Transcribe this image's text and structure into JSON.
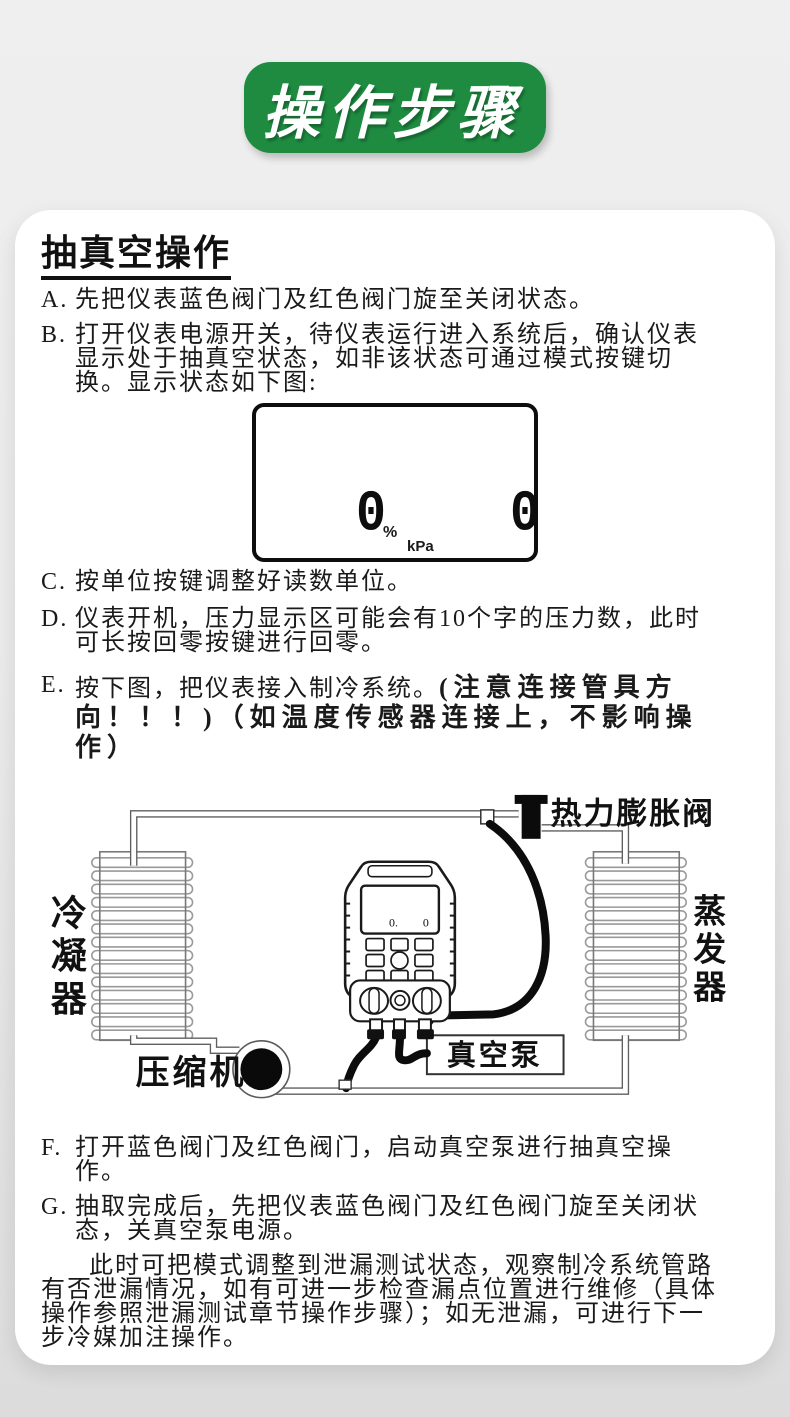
{
  "badge": {
    "title": "操作步骤",
    "color": "#1e8b41"
  },
  "section": {
    "heading": "抽真空操作"
  },
  "steps": [
    {
      "label": "A.",
      "text": "先把仪表蓝色阀门及红色阀门旋至关闭状态。"
    },
    {
      "label": "B.",
      "text": "打开仪表电源开关，待仪表运行进入系统后，确认仪表显示处于抽真空状态，如非该状态可通过模式按键切换。显示状态如下图:"
    },
    {
      "label": "C.",
      "text": "按单位按键调整好读数单位。"
    },
    {
      "label": "D.",
      "text": "仪表开机，压力显示区可能会有10个字的压力数，此时可长按回零按键进行回零。"
    },
    {
      "label": "E.",
      "text": "按下图，把仪表接入制冷系统。",
      "note": "(注意连接管具方向！！！)（如温度传感器连接上，不影响操作）"
    },
    {
      "label": "F.",
      "text": "打开蓝色阀门及红色阀门，启动真空泵进行抽真空操作。"
    },
    {
      "label": "G.",
      "text": "抽取完成后，先把仪表蓝色阀门及红色阀门旋至关闭状态，关真空泵电源。"
    }
  ],
  "closing_paragraph": "此时可把模式调整到泄漏测试状态，观察制冷系统管路有否泄漏情况，如有可进一步检查漏点位置进行维修（具体操作参照泄漏测试章节操作步骤）；如无泄漏，可进行下一步冷媒加注操作。",
  "lcd": {
    "left_value": "0",
    "percent": "%",
    "unit": "kPa",
    "right_value": "0"
  },
  "diagram": {
    "labels": {
      "condenser": "冷凝器",
      "evaporator": "蒸发器",
      "compressor": "压缩机",
      "vacuum_pump": "真空泵",
      "expansion_valve": "热力膨胀阀"
    },
    "device_display_left": "0.",
    "device_display_right": "0"
  }
}
